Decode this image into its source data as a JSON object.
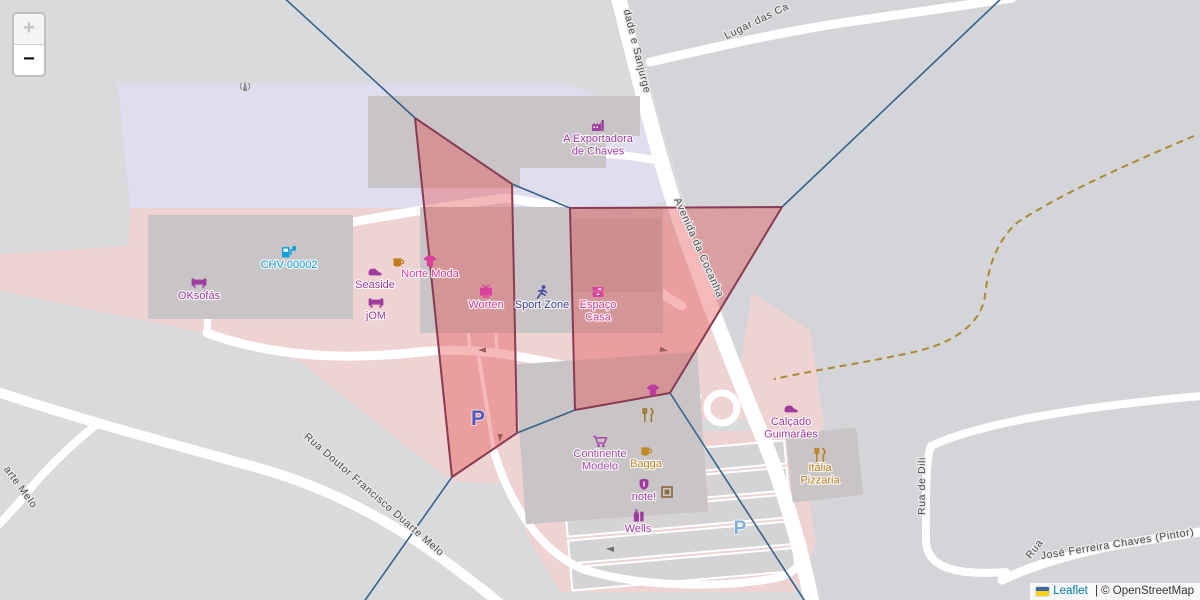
{
  "controls": {
    "zoom_in": "+",
    "zoom_out": "−"
  },
  "attribution": {
    "leaflet": "Leaflet",
    "rest": " | © OpenStreetMap",
    "flag_top": "#4566ab",
    "flag_bottom": "#f7d117"
  },
  "map": {
    "background": "#d9dadc",
    "right_area": {
      "fill": "#d3d5d8",
      "points": [
        [
          628,
          0
        ],
        [
          660,
          120
        ],
        [
          700,
          250
        ],
        [
          762,
          420
        ],
        [
          795,
          520
        ],
        [
          822,
          600
        ],
        [
          1200,
          600
        ],
        [
          1200,
          0
        ]
      ]
    },
    "zones": [
      {
        "name": "retail-zone-lavender",
        "fill": "#e0ddee",
        "points": [
          [
            118,
            84
          ],
          [
            570,
            84
          ],
          [
            648,
            120
          ],
          [
            668,
            200
          ],
          [
            640,
            208
          ],
          [
            130,
            208
          ]
        ]
      },
      {
        "name": "commercial-zone-pink",
        "fill": "#eed3d2",
        "points": [
          [
            130,
            208
          ],
          [
            662,
            208
          ],
          [
            700,
            300
          ],
          [
            757,
            420
          ],
          [
            700,
            420
          ],
          [
            575,
            418
          ],
          [
            520,
            484
          ],
          [
            452,
            482
          ],
          [
            300,
            362
          ],
          [
            205,
            333
          ],
          [
            0,
            291
          ],
          [
            0,
            254
          ],
          [
            128,
            246
          ]
        ]
      },
      {
        "name": "pink-strip-east",
        "fill": "#eed3d2",
        "points": [
          [
            752,
            293
          ],
          [
            810,
            330
          ],
          [
            824,
            425
          ],
          [
            795,
            527
          ],
          [
            766,
            458
          ],
          [
            740,
            368
          ]
        ]
      },
      {
        "name": "parking-zone-south",
        "fill": "#eed3d2",
        "points": [
          [
            505,
            462
          ],
          [
            560,
            433
          ],
          [
            800,
            430
          ],
          [
            816,
            545
          ],
          [
            795,
            592
          ],
          [
            560,
            592
          ],
          [
            528,
            538
          ]
        ]
      }
    ],
    "parking_rows": {
      "rotate": [
        -5,
        678,
        512
      ],
      "x": 566,
      "y0": 450,
      "w": 224,
      "h": 23,
      "gap": 27,
      "count": 5,
      "fill": "#d6d3d5",
      "stroke": "#ffffff"
    },
    "roads": [
      {
        "name": "avenida-da-cocanha",
        "w": 15,
        "d": "M617,-8 C638,75 663,178 690,250 C716,322 744,393 764,440 C784,490 801,548 813,608"
      },
      {
        "name": "lugar-das-ca",
        "w": 9,
        "d": "M650,62 C720,46 790,30 855,21 C905,14 960,6 1012,-2"
      },
      {
        "name": "exportadora-access",
        "w": 8,
        "d": "M548,150 C600,152 638,156 664,162"
      },
      {
        "name": "service-road-north",
        "w": 9,
        "d": "M216,249 C320,226 430,208 506,198 L562,207 C602,246 636,280 682,306"
      },
      {
        "name": "service-road-west",
        "w": 7,
        "d": "M216,249 C211,278 208,300 207,333"
      },
      {
        "name": "service-road-curve",
        "w": 9,
        "d": "M207,333 C262,353 332,362 420,352 C472,346 522,356 576,368 C622,378 662,382 697,396"
      },
      {
        "name": "parking-lane-1",
        "w": 3,
        "d": "M459,236 L470,350"
      },
      {
        "name": "parking-lane-2",
        "w": 3,
        "d": "M489,232 L497,350"
      },
      {
        "name": "parking-lane-3",
        "w": 4,
        "d": "M479,358 L494,452"
      },
      {
        "name": "service-road-south",
        "w": 8,
        "d": "M494,452 C511,507 541,551 582,569 C642,588 722,588 776,578 C801,572 807,556 801,540"
      },
      {
        "name": "rua-doutor-francisco-duarte-melo",
        "w": 10,
        "d": "M-8,390 C80,420 180,446 262,469 C342,492 402,530 441,558 C472,581 492,596 507,610"
      },
      {
        "name": "arte-melo-branch",
        "w": 8,
        "d": "M97,424 C70,446 44,471 26,494 C13,510 2,521 -6,530"
      },
      {
        "name": "rua-de-dili",
        "w": 8,
        "d": "M1202,396 C1120,403 990,418 931,446 C925,463 926,500 926,540 C926,566 952,576 1006,572"
      },
      {
        "name": "rua-jose-ferreira-chaves",
        "w": 9,
        "d": "M1002,580 C1042,561 1090,549 1140,541 L1206,531"
      }
    ],
    "roundabout": {
      "cx": 722,
      "cy": 408,
      "r": 15,
      "w": 7
    },
    "dashed_path": {
      "color": "#ab8a34",
      "w": 2,
      "dash": "7 5",
      "d": "M1194,136 C1118,168 1058,196 1018,222 C996,241 988,268 985,296 C981,322 958,341 918,351 C876,361 820,369 774,379"
    },
    "buildings": [
      {
        "name": "building-exportadora-a",
        "x": 368,
        "y": 96,
        "w": 152,
        "h": 92
      },
      {
        "name": "building-exportadora-b",
        "x": 430,
        "y": 96,
        "w": 210,
        "h": 40
      },
      {
        "name": "building-exportadora-c",
        "x": 520,
        "y": 118,
        "w": 86,
        "h": 50
      },
      {
        "name": "building-retail-west",
        "x": 148,
        "y": 215,
        "w": 205,
        "h": 104
      },
      {
        "name": "building-retail-center",
        "x": 420,
        "y": 207,
        "w": 243,
        "h": 126
      },
      {
        "name": "building-espaco-casa",
        "x": 573,
        "y": 218,
        "w": 88,
        "h": 74,
        "fill": "#c0babc"
      },
      {
        "name": "building-continente",
        "x": 520,
        "y": 358,
        "w": 183,
        "h": 160,
        "rotate": [
          -4,
          610,
          438
        ]
      },
      {
        "name": "building-italia",
        "x": 789,
        "y": 431,
        "w": 71,
        "h": 68,
        "rotate": [
          -6,
          824,
          465
        ]
      }
    ],
    "building_fill": "#c9c5c7",
    "arrows": [
      {
        "x": 482,
        "y": 350,
        "r": 180
      },
      {
        "x": 500,
        "y": 438,
        "r": 95
      },
      {
        "x": 610,
        "y": 549,
        "r": 185
      },
      {
        "x": 664,
        "y": 350,
        "r": 10
      }
    ],
    "voronoi": {
      "line_color": "#35638f",
      "cell_fill": "rgba(228,72,72,0.38)",
      "cell_stroke": "#8a3a52",
      "lines": [
        [
          280,
          -6,
          415,
          118
        ],
        [
          512,
          184,
          570,
          208
        ],
        [
          782,
          207,
          1006,
          -6
        ],
        [
          670,
          393,
          808,
          606
        ],
        [
          517,
          433,
          575,
          410
        ],
        [
          452,
          477,
          361,
          606
        ]
      ],
      "cells": [
        {
          "name": "voronoi-cell-west",
          "points": [
            [
              415,
              118
            ],
            [
              512,
              184
            ],
            [
              517,
              433
            ],
            [
              452,
              477
            ]
          ]
        },
        {
          "name": "voronoi-cell-east",
          "points": [
            [
              570,
              208
            ],
            [
              782,
              207
            ],
            [
              670,
              393
            ],
            [
              575,
              410
            ]
          ]
        }
      ]
    },
    "street_labels": [
      {
        "name": "street-label-sanjurge",
        "text": "dade e Sanjurge",
        "x": 634,
        "y": 52,
        "rotate": 76,
        "size": 10.5
      },
      {
        "name": "street-label-lugar-das-ca",
        "text": "Lugar das Ca",
        "x": 758,
        "y": 24,
        "rotate": -26,
        "size": 10.5
      },
      {
        "name": "street-label-avenida-da-cocanha",
        "text": "Avenida da Cocanha",
        "x": 696,
        "y": 249,
        "rotate": 66,
        "size": 10.5
      },
      {
        "name": "street-label-rua-doutor",
        "text": "Rua Doutor Francisco Duarte Melo",
        "x": 372,
        "y": 497,
        "rotate": 41,
        "size": 10.5
      },
      {
        "name": "street-label-arte-melo",
        "text": "arte Melo",
        "x": 18,
        "y": 489,
        "rotate": 54,
        "size": 10.5
      },
      {
        "name": "street-label-rua-de-dili",
        "text": "Rua de Dili",
        "x": 925,
        "y": 486,
        "rotate": -90,
        "size": 10.5
      },
      {
        "name": "street-label-rua",
        "text": "Rua",
        "x": 1037,
        "y": 551,
        "rotate": -52,
        "size": 10.5
      },
      {
        "name": "street-label-jose-ferreira",
        "text": "José Ferreira Chaves (Pintor)",
        "x": 1118,
        "y": 547,
        "rotate": -9,
        "size": 10.5
      }
    ],
    "pois": [
      {
        "name": "antenna-mast",
        "icon": "mast",
        "x": 245,
        "y": 87,
        "color": "#8c8c8c",
        "lines": []
      },
      {
        "name": "a-exportadora-de-chaves",
        "icon": "factory",
        "x": 598,
        "y": 126,
        "color": "#a03ca0",
        "lines": [
          "A Exportadora",
          "de Chaves"
        ]
      },
      {
        "name": "chv-00002",
        "icon": "fuel",
        "x": 289,
        "y": 252,
        "color": "#09a2d8",
        "lines": [
          "CHV-00002"
        ]
      },
      {
        "name": "oksofas",
        "icon": "sofa",
        "x": 199,
        "y": 283,
        "color": "#a03ca0",
        "lines": [
          "OKsofás"
        ]
      },
      {
        "name": "seaside",
        "icon": "shoe",
        "x": 375,
        "y": 272,
        "color": "#a03ca0",
        "lines": [
          "Seaside"
        ]
      },
      {
        "name": "jom",
        "icon": "sofa",
        "x": 376,
        "y": 303,
        "color": "#a03ca0",
        "lines": [
          "jOM"
        ]
      },
      {
        "name": "cafe",
        "icon": "cup",
        "x": 398,
        "y": 262,
        "color": "#bf7d1e",
        "lines": []
      },
      {
        "name": "norte-moda",
        "icon": "tshirt",
        "x": 430,
        "y": 261,
        "color": "#d9419c",
        "lines": [
          "Norte Moda"
        ]
      },
      {
        "name": "worten",
        "icon": "tv",
        "x": 486,
        "y": 292,
        "color": "#d9419c",
        "lines": [
          "Worten"
        ]
      },
      {
        "name": "sport-zone",
        "icon": "runner",
        "x": 542,
        "y": 292,
        "color": "#4d4da8",
        "label_color": "#3e3e92",
        "lines": [
          "Sport Zone"
        ]
      },
      {
        "name": "espaco-casa",
        "icon": "shelf",
        "x": 598,
        "y": 292,
        "color": "#d9419c",
        "lines": [
          "Espaço",
          "Casa"
        ]
      },
      {
        "name": "clothes-shop",
        "icon": "tshirt",
        "x": 653,
        "y": 390,
        "color": "#c13a9e",
        "lines": []
      },
      {
        "name": "restaurant",
        "icon": "cutlery",
        "x": 648,
        "y": 415,
        "color": "#9c7a2e",
        "lines": []
      },
      {
        "name": "continente-modelo",
        "icon": "cart",
        "x": 600,
        "y": 441,
        "color": "#a84fa8",
        "lines": [
          "Continente",
          "Modelo"
        ]
      },
      {
        "name": "bagga",
        "icon": "cup",
        "x": 646,
        "y": 451,
        "color": "#c08a28",
        "lines": [
          "Bagga"
        ]
      },
      {
        "name": "note",
        "icon": "shield",
        "x": 644,
        "y": 484,
        "color": "#a03ca0",
        "lines": [
          "note!"
        ]
      },
      {
        "name": "photo-kiosk",
        "icon": "frame",
        "x": 667,
        "y": 492,
        "color": "#8a6d3b",
        "lines": []
      },
      {
        "name": "wells",
        "icon": "bottle",
        "x": 638,
        "y": 516,
        "color": "#a03ca0",
        "lines": [
          "Wells"
        ]
      },
      {
        "name": "calcado-guimaraes",
        "icon": "shoe",
        "x": 791,
        "y": 409,
        "color": "#a03ca0",
        "lines": [
          "Calçado",
          "Guimarães"
        ]
      },
      {
        "name": "italia-pizzaria",
        "icon": "cutlery",
        "x": 820,
        "y": 455,
        "color": "#bf7d1e",
        "lines": [
          "Itália",
          "Pizzaria"
        ]
      }
    ],
    "parking_labels": [
      {
        "name": "parking-west",
        "text": "P",
        "x": 478,
        "y": 425,
        "color": "#4a5cc0",
        "size": 21
      },
      {
        "name": "parking-south",
        "text": "P",
        "x": 740,
        "y": 534,
        "color": "#7fb2d8",
        "size": 19
      }
    ]
  }
}
